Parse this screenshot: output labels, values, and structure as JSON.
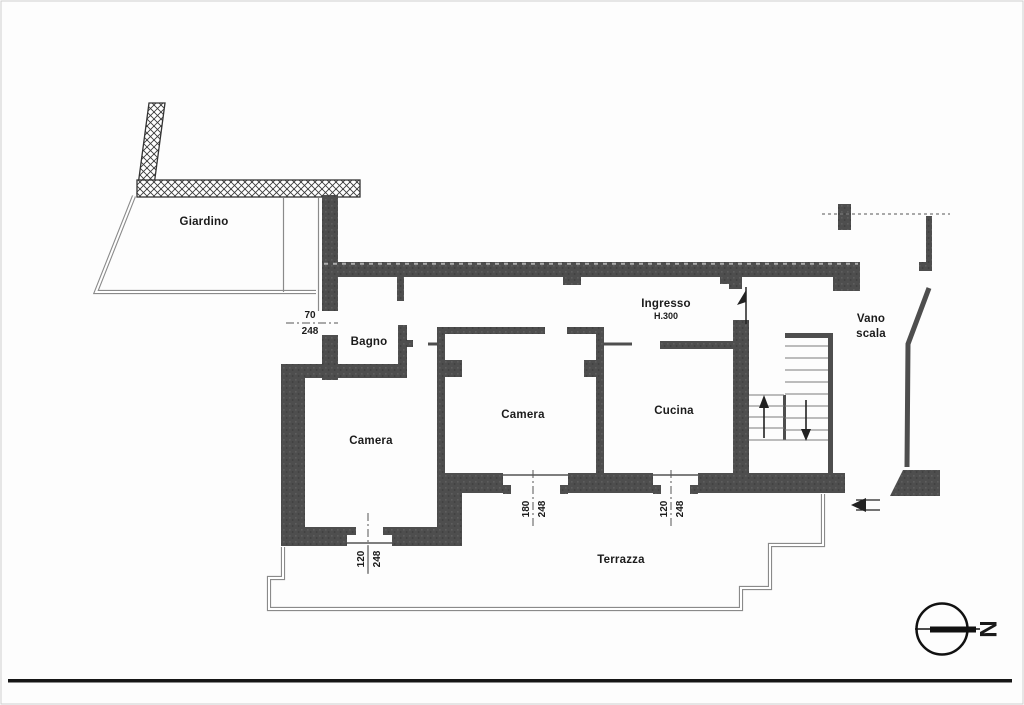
{
  "document": {
    "type": "floor-plan",
    "rooms": {
      "giardino": "Giardino",
      "bagno": "Bagno",
      "camera_left": "Camera",
      "camera_mid": "Camera",
      "cucina": "Cucina",
      "ingresso": "Ingresso",
      "ingresso_height": "H.300",
      "vano_scala_line1": "Vano",
      "vano_scala_line2": "scala",
      "terrazza": "Terrazza"
    },
    "dimensions": {
      "door_bagno": {
        "w": "70",
        "h": "248"
      },
      "window_camera_left": {
        "w": "120",
        "h": "248"
      },
      "window_camera_mid": {
        "w": "180",
        "h": "248"
      },
      "window_cucina": {
        "w": "120",
        "h": "248"
      }
    },
    "compass": {
      "north": "N"
    },
    "colors": {
      "wall": "#4e4e4e",
      "hatch_line": "#3a3a3a",
      "fence_line": "#8a8a8a",
      "text": "#1b1b1b",
      "page_rule": "#161616"
    }
  }
}
